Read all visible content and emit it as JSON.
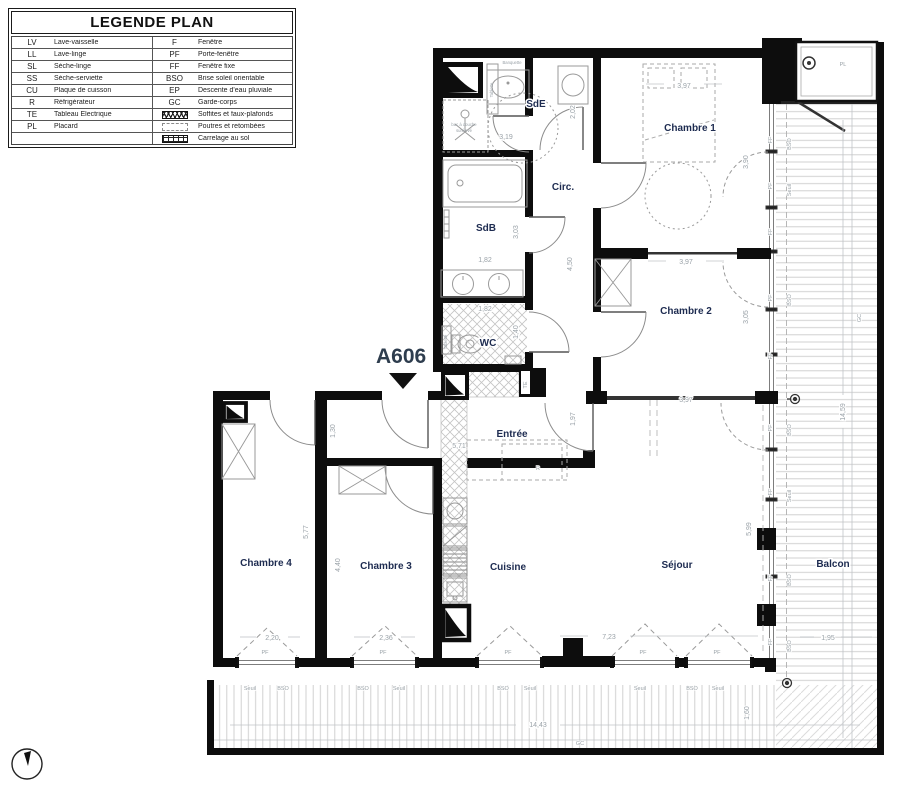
{
  "legend": {
    "title": "LEGENDE PLAN",
    "left": [
      {
        "abbr": "LV",
        "label": "Lave-vaisselle"
      },
      {
        "abbr": "LL",
        "label": "Lave-linge"
      },
      {
        "abbr": "SL",
        "label": "Sèche-linge"
      },
      {
        "abbr": "SS",
        "label": "Sèche-serviette"
      },
      {
        "abbr": "CU",
        "label": "Plaque de cuisson"
      },
      {
        "abbr": "R",
        "label": "Réfrigérateur"
      },
      {
        "abbr": "TE",
        "label": "Tableau Electrique"
      },
      {
        "abbr": "PL",
        "label": "Placard"
      },
      {
        "abbr": "",
        "label": ""
      }
    ],
    "right": [
      {
        "abbr": "F",
        "label": "Fenêtre"
      },
      {
        "abbr": "PF",
        "label": "Porte-fenêtre"
      },
      {
        "abbr": "FF",
        "label": "Fenêtre fixe"
      },
      {
        "abbr": "BSO",
        "label": "Brise soleil orientable"
      },
      {
        "abbr": "EP",
        "label": "Descente d'eau pluviale"
      },
      {
        "abbr": "GC",
        "label": "Garde-corps"
      },
      {
        "abbr": "",
        "label": "Soffites et faux-plafonds"
      },
      {
        "abbr": "",
        "label": "Poutres et retombées"
      },
      {
        "abbr": "",
        "label": "Carrelage au sol"
      }
    ]
  },
  "unit": {
    "number": "A606"
  },
  "rooms": {
    "sde": "SdE",
    "ch1": "Chambre 1",
    "circ": "Circ.",
    "sdb": "SdB",
    "ch2": "Chambre 2",
    "wc": "WC",
    "entree": "Entrée",
    "ch4": "Chambre 4",
    "ch3": "Chambre 3",
    "cuisine": "Cuisine",
    "sejour": "Séjour",
    "balcon": "Balcon"
  },
  "dims": {
    "sde_w": "3,19",
    "sde_d": "2,02",
    "ch1_w": "3,97",
    "ch1_d": "3,90",
    "ch2_w": "3,97",
    "ch2_d": "3,05",
    "ch2_w2": "3,97",
    "sdb_w": "1,82",
    "sdb_d": "3,03",
    "circ_d": "4,50",
    "wc_w": "1,82",
    "wc_d": "1,40",
    "entree_w": "5,71",
    "entree_d": "1,97",
    "hall_d": "1,30",
    "ch4_d": "5,77",
    "ch3_d": "4,40",
    "ch4_win": "2,20",
    "ch3_win": "2,36",
    "sejour_w": "7,23",
    "sejour_d": "5,99",
    "balcon_h": "14,59",
    "balcon_w": "1,95",
    "balcon_bw": "14,43",
    "balcon_bd": "1,60"
  },
  "marks": {
    "pf": "PF",
    "ff": "FF",
    "bso": "BSO",
    "seuil": "Seuil",
    "gc": "GC",
    "te": "TE",
    "pl": "PL",
    "r": "R",
    "tablette": "Tablette",
    "banquette": "Banquette",
    "bac1": "bac à douche",
    "bac2": "surélevé"
  }
}
